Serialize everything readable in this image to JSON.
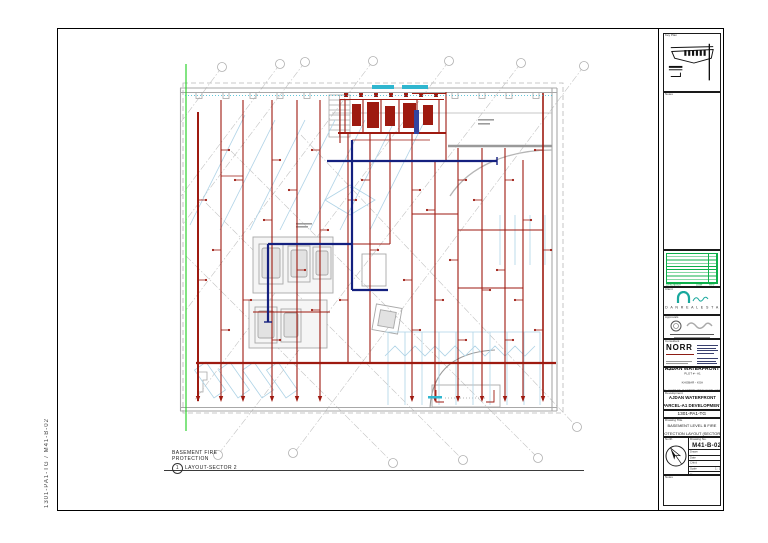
{
  "margin": {
    "plot_stamp": "1301-PA1-TG  /  M41-B-02"
  },
  "plan": {
    "view_title_lines": [
      "BASEMENT FIRE",
      "PROTECTION",
      "LAYOUT-SECTOR 2"
    ],
    "view_tag": "1",
    "colors": {
      "fire_main_red": "#9e1a10",
      "standpipe_navy": "#14207f",
      "grid_green": "#2fd12f",
      "annotation_cyan": "#2fb6cf",
      "walls_gray": "#a8a8a8",
      "parking_blue": "#aed3e6"
    }
  },
  "titleblock": {
    "key_plan": {
      "label": "Key Plan"
    },
    "notes": {
      "label": "Notes"
    },
    "revisions": {
      "description_header": "Description",
      "date_header": "Date",
      "rev_header": "Rev",
      "row_count": 10,
      "grid_color": "#0db04b"
    },
    "client": {
      "label": "Client",
      "name": "A J D A N   R E A L   E S T A T E",
      "logo_color": "#19a89d"
    },
    "stamps": {
      "label": "Approvals"
    },
    "consultant": {
      "label": "Consultant",
      "name": "NORR"
    },
    "project": {
      "label": "Project",
      "name": "AJDAN WATERFRONT",
      "address_lines": [
        "PLOT # - A1",
        "KHOBAR - KSA",
        "AL KHOBAR, EASTERN PROVINCE, KSA"
      ]
    },
    "development": {
      "label": "Development",
      "line1": "AJDAN WATERFRONT",
      "line2": "PARCEL-A1 DEVELOPMENT"
    },
    "project_no": {
      "label": "Project No.",
      "value": "1301-PA1-TG"
    },
    "drawing_title": {
      "label": "Drawing Title",
      "line1": "BASEMENT LEVEL B FIRE",
      "line2": "PROTECTION LAYOUT (SECTOR 2)"
    },
    "north": {
      "label": "North"
    },
    "drawing_no": {
      "label": "Drawing No.",
      "value": "M41-B-02"
    },
    "fields": [
      {
        "label": "Drawn",
        "value": "-"
      },
      {
        "label": "Date",
        "value": "-"
      },
      {
        "label": "Chk'd",
        "value": "-"
      },
      {
        "label": "Scale",
        "value": "1 : 150"
      },
      {
        "label": "Size",
        "value": "A0"
      }
    ],
    "notes2": {
      "label": "Notes"
    }
  }
}
